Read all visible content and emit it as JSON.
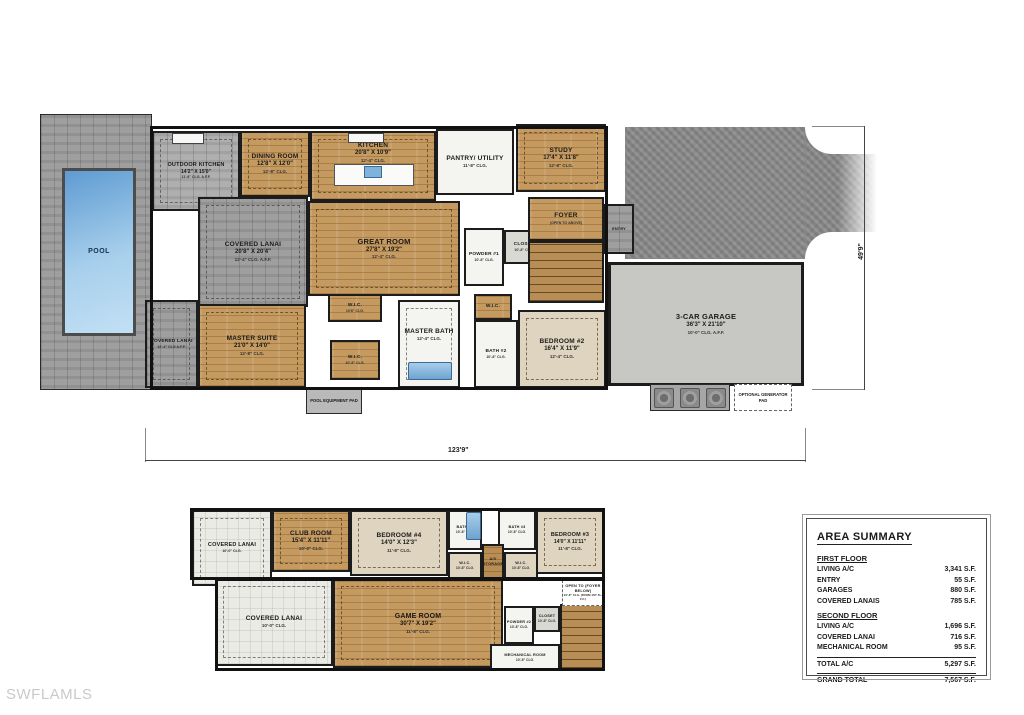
{
  "watermark": "SWFLAMLS",
  "dimensions": {
    "overall_width": "123'9\"",
    "overall_height": "49'9\""
  },
  "first_floor": {
    "pool": {
      "name": "POOL"
    },
    "outdoor_kitchen": {
      "name": "OUTDOOR KITCHEN",
      "size": "14'2\" X 15'0\"",
      "note": "11'-8\" CLG. A.F.F."
    },
    "dining_room": {
      "name": "DINING ROOM",
      "size": "12'8\" X 12'0\"",
      "note": "12'-8\" CLG."
    },
    "kitchen": {
      "name": "KITCHEN",
      "size": "20'8\" X 10'9\"",
      "note": "12'-4\" CLG."
    },
    "pantry_utility": {
      "name": "PANTRY/ UTILITY",
      "note": "11'-8\" CLG."
    },
    "study": {
      "name": "STUDY",
      "size": "17'4\" X 11'8\"",
      "note": "12'-8\" CLG."
    },
    "covered_lanai": {
      "name": "COVERED LANAI",
      "size": "20'8\" X 20'4\"",
      "note": "12'-4\" CLG. A.F.F."
    },
    "great_room": {
      "name": "GREAT ROOM",
      "size": "27'8\" X 19'2\"",
      "note": "12'-4\" CLG."
    },
    "foyer": {
      "name": "FOYER",
      "note": "(OPEN TO ABOVE)"
    },
    "entry": {
      "name": "ENTRY"
    },
    "closet": {
      "name": "CLOSET",
      "note": "10'-8\" CLG."
    },
    "powder_1": {
      "name": "POWDER #1",
      "note": "10'-8\" CLG."
    },
    "covered_lanai_small": {
      "name": "COVERED LANAI",
      "note": "12'-4\" CLG A.F.F."
    },
    "master_suite": {
      "name": "MASTER SUITE",
      "size": "21'0\" X 14'0\"",
      "note": "12'-8\" CLG."
    },
    "wic_a": {
      "name": "W.I.C.",
      "note": "10'8\" CLG."
    },
    "wic_b": {
      "name": "W.I.C.",
      "note": "10'-8\" CLG."
    },
    "wic_c": {
      "name": "W.I.C."
    },
    "master_bath": {
      "name": "MASTER BATH",
      "note": "12'-4\" CLG."
    },
    "bath_2": {
      "name": "BATH #2",
      "note": "10'-8\" CLG."
    },
    "bedroom_2": {
      "name": "BEDROOM #2",
      "size": "16'4\" X 11'9\"",
      "note": "12'-4\" CLG."
    },
    "garage": {
      "name": "3-CAR GARAGE",
      "size": "36'3\" X 21'10\"",
      "note": "10'-0\" CLG. A.F.F."
    },
    "pool_equipment_pad": {
      "name": "POOL EQUIPMENT PAD"
    },
    "optional_generator_pad": {
      "name": "OPTIONAL GENERATOR PAD"
    }
  },
  "second_floor": {
    "covered_lanai_front": {
      "name": "COVERED LANAI",
      "note": "10'-0\" CLG."
    },
    "club_room": {
      "name": "CLUB ROOM",
      "size": "15'4\" X 11'11\"",
      "note": "10'-0\" CLG."
    },
    "bedroom_4": {
      "name": "BEDROOM #4",
      "size": "14'0\" X 12'3\"",
      "note": "11'-8\" CLG."
    },
    "bath_4": {
      "name": "BATH #4",
      "note": "10'-8\" CLG."
    },
    "bath_3": {
      "name": "BATH #3",
      "note": "10'-8\" CLG."
    },
    "av_storage": {
      "name": "A/V STORAGE"
    },
    "wic_a": {
      "name": "W.I.C.",
      "note": "10'-8\" CLG."
    },
    "wic_b": {
      "name": "W.I.C.",
      "note": "10'-8\" CLG."
    },
    "bedroom_3": {
      "name": "BEDROOM #3",
      "size": "14'0\" X 11'11\"",
      "note": "11'-8\" CLG."
    },
    "covered_lanai_rear": {
      "name": "COVERED LANAI",
      "note": "10'-0\" CLG."
    },
    "game_room": {
      "name": "GAME ROOM",
      "size": "30'7\" X 19'2\"",
      "note": "11'-8\" CLG."
    },
    "powder_2": {
      "name": "POWDER #2",
      "note": "10'-8\" CLG."
    },
    "closet": {
      "name": "CLOSET",
      "note": "10'-8\" CLG."
    },
    "mechanical_room": {
      "name": "MECHANICAL ROOM",
      "note": "10'-8\" CLG."
    },
    "open_to_foyer": {
      "name": "OPEN TO (FOYER BELOW)",
      "note": "24'-8\" CLG. (FROM 1ST FL. F.F.)"
    }
  },
  "area_summary": {
    "title": "AREA SUMMARY",
    "first_floor": {
      "heading": "FIRST FLOOR",
      "rows": [
        {
          "label": "LIVING A/C",
          "value": "3,341 S.F."
        },
        {
          "label": "ENTRY",
          "value": "55 S.F."
        },
        {
          "label": "GARAGES",
          "value": "880 S.F."
        },
        {
          "label": "COVERED LANAIS",
          "value": "785 S.F."
        }
      ]
    },
    "second_floor": {
      "heading": "SECOND FLOOR",
      "rows": [
        {
          "label": "LIVING A/C",
          "value": "1,696 S.F."
        },
        {
          "label": "COVERED LANAI",
          "value": "716 S.F."
        },
        {
          "label": "MECHANICAL ROOM",
          "value": "95 S.F."
        }
      ]
    },
    "totals": [
      {
        "label": "TOTAL A/C",
        "value": "5,297 S.F."
      },
      {
        "label": "GRAND TOTAL",
        "value": "7,567 S.F."
      }
    ]
  }
}
